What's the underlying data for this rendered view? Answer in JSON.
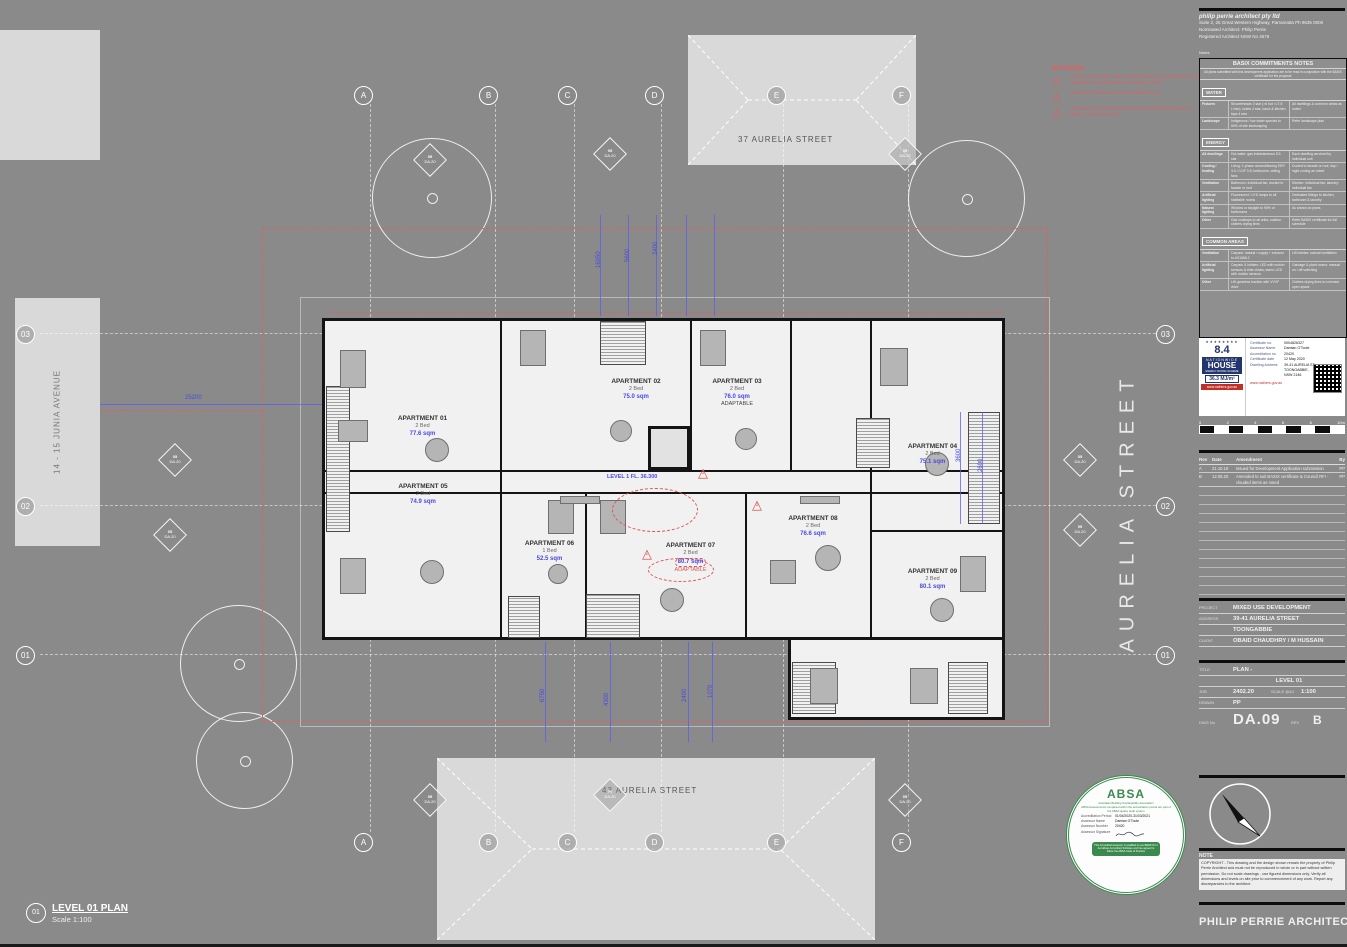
{
  "sheet": {
    "firm_name": "PHILIP PERRIE ARCHITECT",
    "architect_lines": [
      "philip perrie architect pty ltd",
      "Suite 2, 25 Great Western Highway, Parramatta  Ph 9635 0000",
      "Nominated Architect: Philip Perrie",
      "Registered Architect NSW No 4576"
    ],
    "notes_label": "Notes",
    "note_title": "NOTE",
    "note_text": "COPYRIGHT - This drawing and the design shown remain the property of Philip Perrie Architect and must not be reproduced in whole or in part without written permission. Do not scale drawings - use figured dimensions only. Verify all dimensions and levels on site prior to commencement of any work. Report any discrepancies to the architect."
  },
  "basix": {
    "title": "BASIX COMMITMENTS NOTES",
    "subtitle": "All plans submitted with this development application are to be read in conjunction with the BASIX certificate for the proposal",
    "water_label": "WATER",
    "energy_label": "ENERGY",
    "common_label": "COMMON AREAS",
    "water_rows": [
      [
        "Fixtures",
        "Showerheads 3 star (>6 but <=7.5 L/min); toilets 4 star; basin & kitchen taps 4 star",
        "All dwellings & common areas as noted"
      ],
      [
        "Landscape",
        "Indigenous / low water species to 50% of site landscaping",
        "Refer landscape plan"
      ]
    ],
    "energy_rows": [
      [
        "All dwellings",
        "Hot water: gas instantaneous 5.5 star",
        "Each dwelling serviced by individual unit"
      ],
      [
        "Cooling / heating",
        "Living: 1-phase airconditioning EER 3.0 / COP 3.5; bedrooms: ceiling fans",
        "Ducted to facade or roof; day / night zoning as noted"
      ],
      [
        "Ventilation",
        "Bathroom: individual fan, ducted to facade or roof",
        "Kitchen: individual fan; laundry: individual fan"
      ],
      [
        "Artificial lighting",
        "Fluorescent / LED lamps to all habitable rooms",
        "Dedicated fittings to kitchen, bathroom & laundry"
      ],
      [
        "Natural lighting",
        "Window or skylight to 90% of bathrooms",
        "As shown on plans"
      ],
      [
        "Other",
        "Gas cooktops to all units; outdoor clothes drying lines",
        "Refer BASIX certificate for full schedule"
      ]
    ],
    "common_rows": [
      [
        "Ventilation",
        "Carpark: natural / supply + exhaust to AS1668.2",
        "Lift lobbies: natural ventilation"
      ],
      [
        "Artificial lighting",
        "Carpark & lobbies: LED with motion sensors & time clocks; stairs: LED with motion sensors",
        "Garbage & plant rooms: manual on / off switching"
      ],
      [
        "Other",
        "Lift: gearless traction with VVVF drive",
        "Clothes drying lines to common open space"
      ]
    ]
  },
  "nathers": {
    "star_row": "★★★★★★★★",
    "rating": "8.4",
    "org1": "NATIONWIDE",
    "org2": "HOUSE",
    "org3": "ENERGY RATING SCHEME",
    "mj": "36.3 MJ/m²",
    "url": "www.nathers.gov.au",
    "rows": [
      [
        "Certificate no.",
        "0004826327"
      ],
      [
        "Assessor Name",
        "Damian O'Toole"
      ],
      [
        "Accreditation no.",
        "20420"
      ],
      [
        "Certificate date",
        "12 May 2020"
      ],
      [
        "Dwelling Address",
        "39-41 AURELIA ST TOONGABBIE, NSW 2146"
      ]
    ],
    "link": "www.nathers.gov.au"
  },
  "absa": {
    "name": "ABSA",
    "tagline": "Australian Building Sustainability Association",
    "audit_note": "ABSA Assessments completed within the accreditation period are part of the ABSA quality audit system",
    "rows": [
      [
        "Accreditation Period",
        "01/04/2020-31/03/2021"
      ],
      [
        "Assessor Name",
        "Damian O'Toole"
      ],
      [
        "Assessor Number",
        "20420"
      ],
      [
        "Assessor Signature",
        ""
      ]
    ],
    "footer": "This Accredited Assessor is qualified to use BERS Pro / AccuRate Accredited Software and has agreed to follow the ABSA Code of Practice"
  },
  "scalebar": {
    "labels": [
      "0",
      "2",
      "4",
      "6",
      "8",
      "10m"
    ]
  },
  "revisions": {
    "headers": [
      "Rev",
      "Date",
      "Amendment",
      "By"
    ],
    "rows": [
      [
        "A",
        "21.10.19",
        "Issued for Development Application submission",
        "PP"
      ],
      [
        "B",
        "12.05.20",
        "Amended to suit BASIX certificate & Council RFI - clouded items as noted",
        "PP"
      ]
    ]
  },
  "project": {
    "project_label": "PROJECT",
    "project": "MIXED USE DEVELOPMENT",
    "address_label": "ADDRESS",
    "address1": "39-41 AURELIA STREET",
    "address2": "TOONGABBIE",
    "client_label": "CLIENT",
    "client": "OBAID CHAUDHRY / M HUSSAIN"
  },
  "drawing": {
    "title_label": "TITLE",
    "title1": "PLAN -",
    "title2": "LEVEL 01",
    "job_label": "JOB",
    "job": "2402.20",
    "scale_label": "SCALE @A1",
    "scale": "1:100",
    "drawn_label": "DRAWN",
    "drawn": "PP",
    "dwg_label": "DWG No",
    "dwg": "DA.09",
    "rev_label": "REV",
    "rev": "B"
  },
  "legend": {
    "title": "REVISIONS",
    "triangle_glyph": "△",
    "items": [
      {
        "num": "1",
        "text": "Location of hot water units & clothes drying areas amended to suit, approved in Council email & relocated as noted"
      },
      {
        "num": "2",
        "text": "Apartment 07 layout and area amended to suit."
      },
      {
        "num": "3",
        "text": "Lift & stair core dimensions amended to suit lift manufacturer's details, refer sheet DA.05"
      }
    ]
  },
  "site": {
    "street_right": "AURELIA STREET",
    "street_top": "37 AURELIA STREET",
    "street_bottom": "43 AURELIA STREET",
    "street_left": "14 - 15 JUNIA AVENUE"
  },
  "grid": {
    "cols": [
      "A",
      "B",
      "C",
      "D",
      "E",
      "F"
    ],
    "rows": [
      "03",
      "02",
      "01"
    ]
  },
  "markers": {
    "line1": "05",
    "line2": "DA.20"
  },
  "plan": {
    "level_text": "LEVEL 1 FL. 36.300",
    "apartments": [
      {
        "name": "APARTMENT 01",
        "beds": "2 Bed",
        "area": "77.6 sqm",
        "extra": ""
      },
      {
        "name": "APARTMENT 02",
        "beds": "2 Bed",
        "area": "75.0 sqm",
        "extra": ""
      },
      {
        "name": "APARTMENT 03",
        "beds": "2 Bed",
        "area": "76.0 sqm",
        "extra": "ADAPTABLE"
      },
      {
        "name": "APARTMENT 04",
        "beds": "2 Bed",
        "area": "75.1 sqm",
        "extra": ""
      },
      {
        "name": "APARTMENT 05",
        "beds": "2 Bed",
        "area": "74.9 sqm",
        "extra": ""
      },
      {
        "name": "APARTMENT 06",
        "beds": "1 Bed",
        "area": "52.5 sqm",
        "extra": ""
      },
      {
        "name": "APARTMENT 07",
        "beds": "2 Bed",
        "area": "80.7 sqm",
        "extra": "ADAPTABLE"
      },
      {
        "name": "APARTMENT 08",
        "beds": "2 Bed",
        "area": "76.6 sqm",
        "extra": ""
      },
      {
        "name": "APARTMENT 09",
        "beds": "2 Bed",
        "area": "80.1 sqm",
        "extra": ""
      }
    ],
    "dims": [
      "25200",
      "16950",
      "5600",
      "2400",
      "6750",
      "4300",
      "2400",
      "1070",
      "3600",
      "2600"
    ]
  },
  "plan_title": {
    "num": "01",
    "title": "LEVEL 01 PLAN",
    "scale": "Scale 1:100"
  },
  "colors": {
    "annotation_blue": "#5b5bf0",
    "revision_red": "#e05555",
    "sheet_gray": "#8a8a8a",
    "building_gray": "#d9d9d9",
    "plan_bg": "#f1f1f1"
  }
}
